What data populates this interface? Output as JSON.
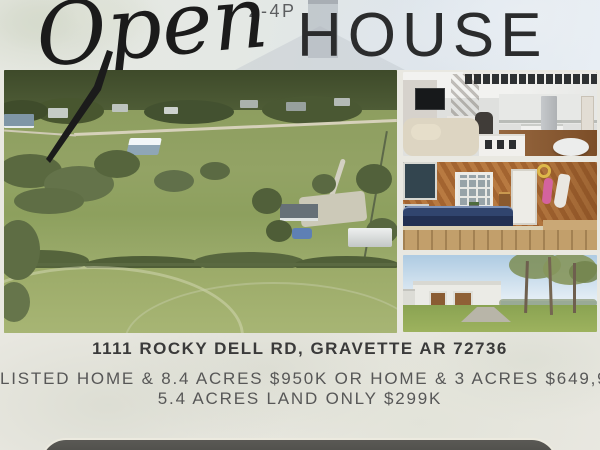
{
  "header": {
    "time_label": "2-4P",
    "script_word": "Open",
    "block_word": "HOUSE"
  },
  "address": {
    "text": "1111 ROCKY DELL RD, GRAVETTE AR 72736"
  },
  "listing": {
    "line1": "LISTED HOME & 8.4 ACRES $950K OR HOME & 3 ACRES $649,999K",
    "line2": "5.4 ACRES LAND ONLY $299K"
  },
  "photos": {
    "main": "aerial-view-of-property-acreage",
    "top_right": "open-concept-living-room-and-kitchen",
    "middle_right": "indoor-hot-tub-room-wood-paneling",
    "bottom_right": "white-metal-shop-building-exterior"
  },
  "colors": {
    "page_background": "#e9e8e1",
    "headline_text": "#2b2c2d",
    "address_text": "#3a3a3a",
    "listing_text": "#575757",
    "cta_button": "#4a4a46",
    "cta_border": "#eceadf"
  }
}
